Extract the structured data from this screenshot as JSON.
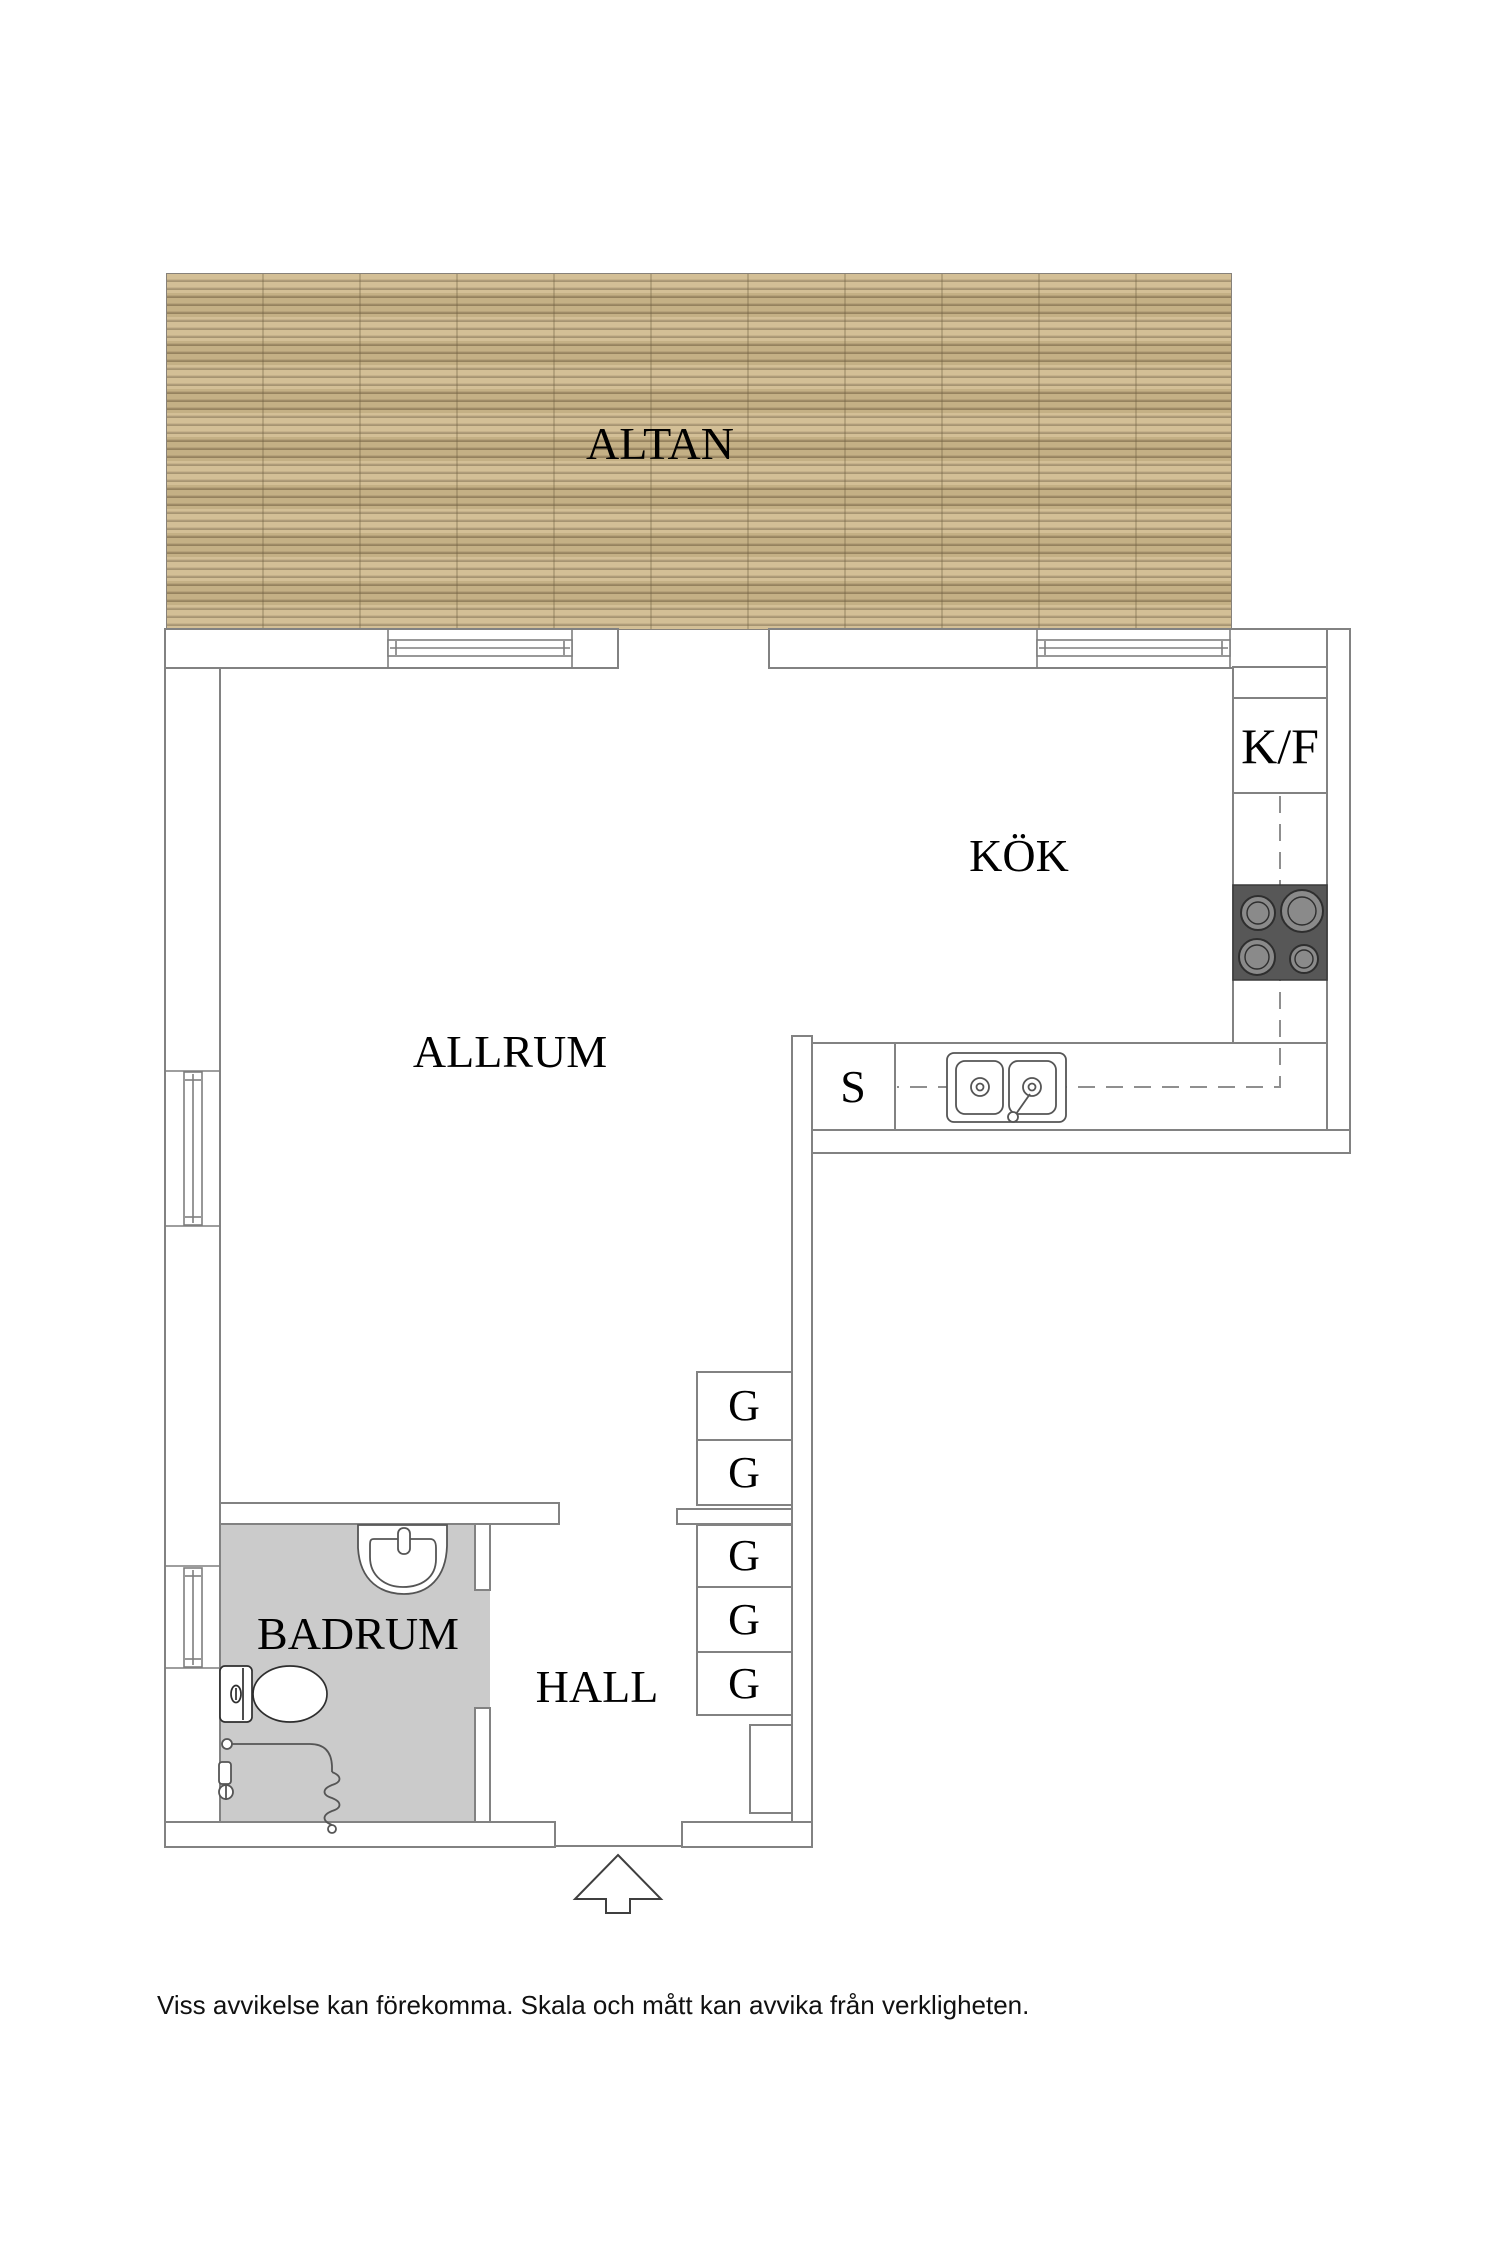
{
  "floorplan": {
    "rooms": {
      "altan": {
        "label": "ALTAN"
      },
      "kok": {
        "label": "KÖK"
      },
      "allrum": {
        "label": "ALLRUM"
      },
      "badrum": {
        "label": "BADRUM"
      },
      "hall": {
        "label": "HALL"
      }
    },
    "kitchen": {
      "fridge_freezer_label": "K/F",
      "counter_s_label": "S"
    },
    "wardrobes": {
      "labels": [
        "G",
        "G",
        "G",
        "G",
        "G"
      ]
    },
    "icons": {
      "stove": "four-burner-stove-icon",
      "sink": "double-bowl-kitchen-sink-icon",
      "toilet": "toilet-icon",
      "washbasin": "washbasin-icon",
      "shower": "shower-hose-icon",
      "entrance": "entrance-arrow-icon",
      "windows": "window-icon",
      "deck": "wood-deck-texture"
    },
    "colors": {
      "deck_base": "#cbb589",
      "deck_line": "#a08c67",
      "bathroom_floor": "#cbcbcb",
      "stove": "#575757",
      "burner": "#8a8a8a",
      "wall_line": "#828282"
    },
    "footer": {
      "disclaimer": "Viss avvikelse kan förekomma. Skala och mått kan avvika från verkligheten."
    }
  }
}
